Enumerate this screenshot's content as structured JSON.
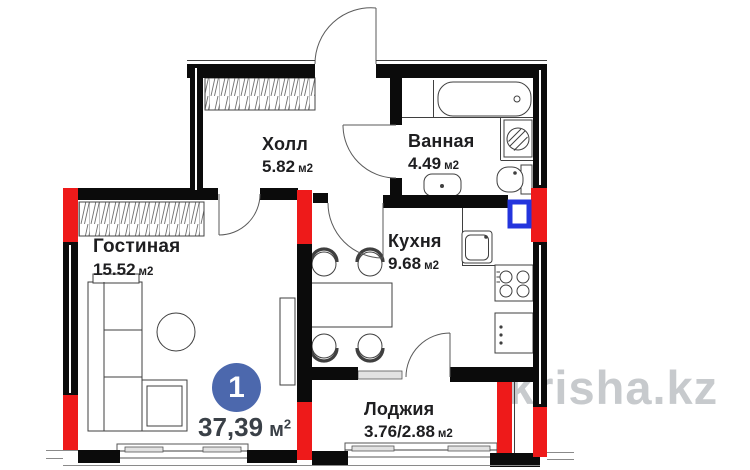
{
  "plan": {
    "rooms": [
      {
        "id": "hall",
        "name": "Холл",
        "area": "5.82",
        "unit": "м2"
      },
      {
        "id": "bathroom",
        "name": "Ванная",
        "area": "4.49",
        "unit": "м2"
      },
      {
        "id": "living",
        "name": "Гостиная",
        "area": "15.52",
        "unit": "м2"
      },
      {
        "id": "kitchen",
        "name": "Кухня",
        "area": "9.68",
        "unit": "м2"
      },
      {
        "id": "loggia",
        "name": "Лоджия",
        "area": "3.76/2.88",
        "unit": "м2"
      }
    ],
    "total": {
      "badge": "1",
      "area": "37,39",
      "unit": "м",
      "sup": "2"
    },
    "watermark": "krisha.kz",
    "colors": {
      "column_red": "#ee1a1a",
      "vent_blue": "#2334dd",
      "badge_blue": "#4c68ad",
      "wall_black": "#0b0b0b",
      "watermark_gray": "#c7cacd"
    }
  }
}
